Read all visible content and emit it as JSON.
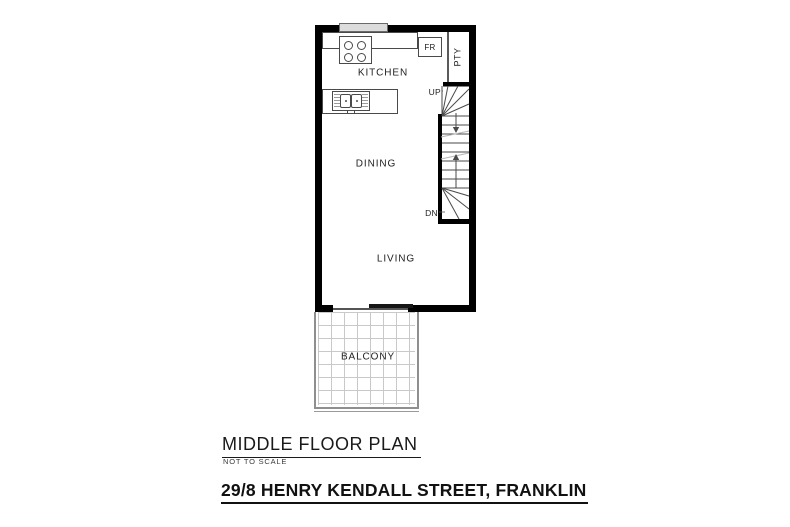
{
  "plan": {
    "rooms": {
      "kitchen": "KITCHEN",
      "dining": "DINING",
      "living": "LIVING",
      "balcony": "BALCONY"
    },
    "features": {
      "fridge": "FR",
      "pantry": "PTY",
      "stairs_up": "UP",
      "stairs_down": "DN"
    }
  },
  "title_block": {
    "title": "MIDDLE FLOOR PLAN",
    "scale_note": "NOT TO SCALE"
  },
  "footer": {
    "address": "29/8 HENRY KENDALL STREET, FRANKLIN"
  },
  "colors": {
    "wall": "#000000",
    "fixture_line": "#4a4a4a",
    "tile_grid": "#c9c9c9",
    "railing": "#8f8f8f",
    "text": "#1c1c1c"
  }
}
